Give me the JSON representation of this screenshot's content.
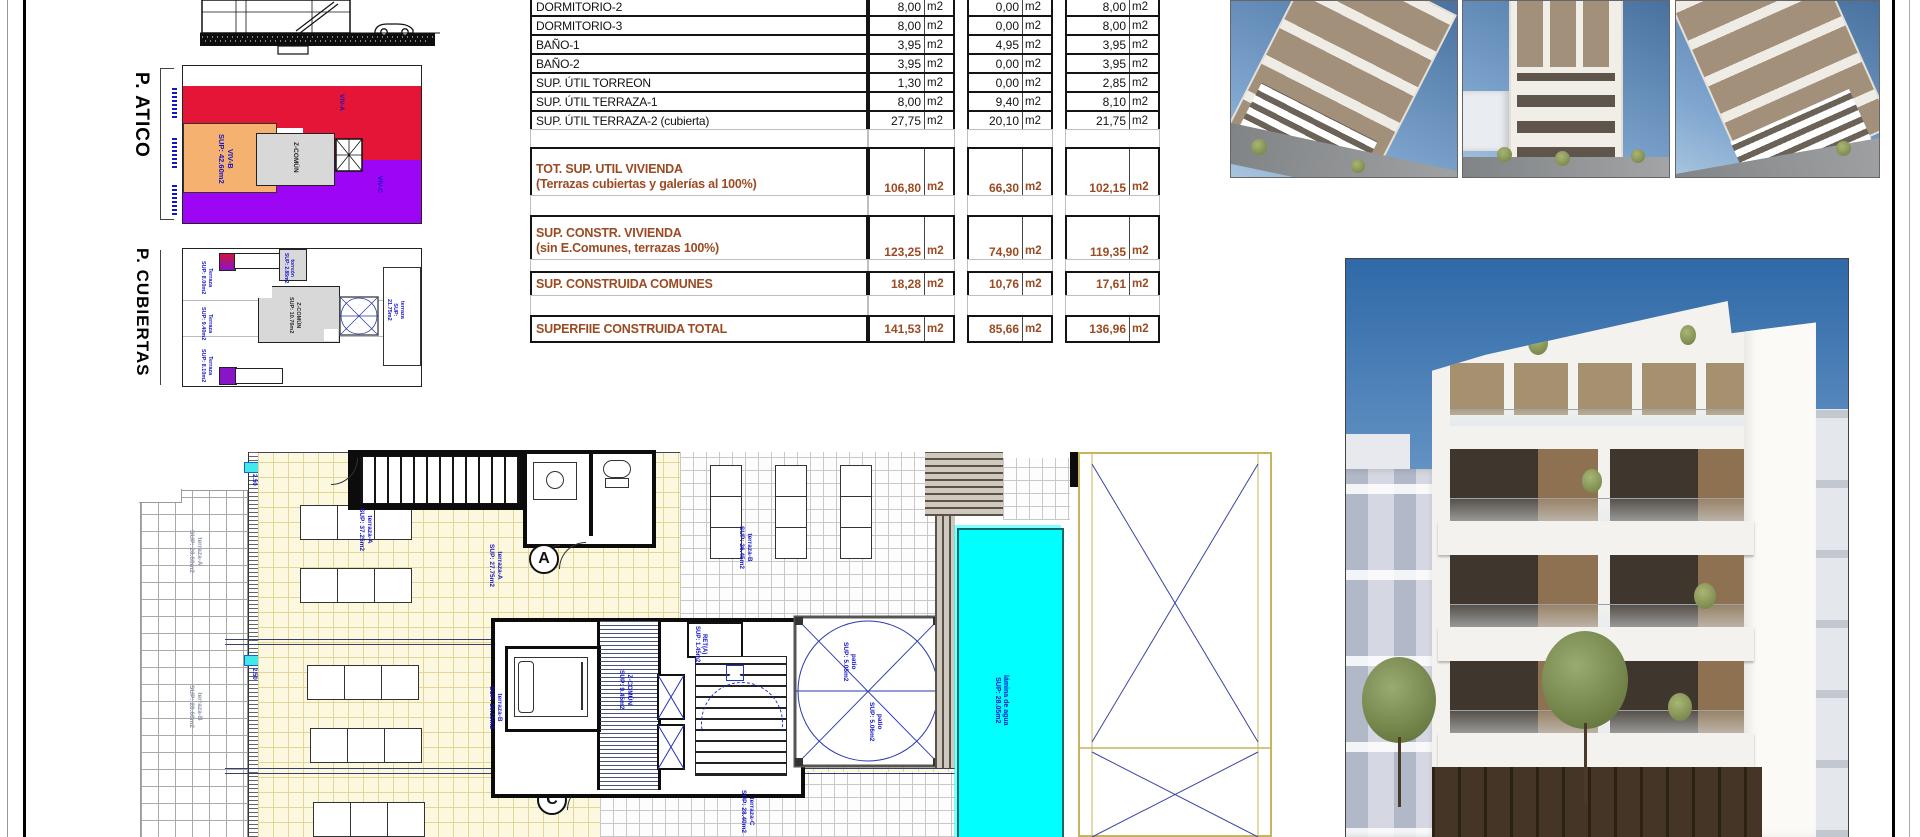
{
  "panels": {
    "atico": {
      "title": "P. ATICO",
      "viv_a": "VIV-A",
      "viv_b": "VIV-B\nSUP: 42.60m2",
      "common": "Z-COMÚN",
      "viv_c": "VIV-C"
    },
    "cubiertas": {
      "title": "P. CUBIERTAS",
      "terraza_1": "Terraza\nSUP: 8.00m2",
      "terraza_2": "Terraza\nSUP: 9.40m2",
      "terraza_3": "Terraza\nSUP: 8.10m2",
      "core": "Z-COMÚN\nSUP: 10.76m2",
      "torreon": "torreón\nSUP: 2.85m2",
      "terraza_r": "terraza\nSUP: 21.75m2"
    }
  },
  "area_table": {
    "unit": "m2",
    "rows": [
      {
        "label": "DORMITORIO-2",
        "v": [
          "8,00",
          "0,00",
          "8,00"
        ]
      },
      {
        "label": "DORMITORIO-3",
        "v": [
          "8,00",
          "0,00",
          "8,00"
        ]
      },
      {
        "label": "BAÑO-1",
        "v": [
          "3,95",
          "4,95",
          "3,95"
        ]
      },
      {
        "label": "BAÑO-2",
        "v": [
          "3,95",
          "0,00",
          "3,95"
        ]
      },
      {
        "label": "SUP. ÚTIL TORREON",
        "v": [
          "1,30",
          "0,00",
          "2,85"
        ]
      },
      {
        "label": "SUP. ÚTIL TERRAZA-1",
        "v": [
          "8,00",
          "9,40",
          "8,10"
        ]
      },
      {
        "label": "SUP. ÚTIL TERRAZA-2 (cubierta)",
        "v": [
          "27,75",
          "20,10",
          "21,75"
        ]
      }
    ],
    "totals": [
      {
        "label": "TOT. SUP. UTIL VIVIENDA",
        "sub": "(Terrazas cubiertas y galerías al 100%)",
        "v": [
          "106,80",
          "66,30",
          "102,15"
        ]
      },
      {
        "label": "SUP. CONSTR. VIVIENDA",
        "sub": "(sin E.Comunes, terrazas 100%)",
        "v": [
          "123,25",
          "74,90",
          "119,35"
        ]
      },
      {
        "label": "SUP. CONSTRUIDA COMUNES",
        "sub": "",
        "v": [
          "18,28",
          "10,76",
          "17,61"
        ]
      },
      {
        "label": "SUPERFIIE CONSTRUIDA TOTAL",
        "sub": "",
        "v": [
          "141,53",
          "85,66",
          "136,96"
        ]
      }
    ]
  },
  "floor_plan": {
    "markers": {
      "a": "A",
      "b": "B",
      "c": "C"
    },
    "labels": {
      "terraza_a1": "terraza-A\nSUP: 37.25m2",
      "terraza_a2": "terraza-A\nSUP: 27.75m2",
      "terraza_b1": "terraza-B\nSUP: 26.45m2",
      "terraza_b2": "terraza-B\nSUP: 20.15m2",
      "terraza_c": "terraza-C\nSUP: 28.40m2",
      "patio_a": "patio\nSUP: 5.05m2",
      "patio_b": "patio\nSUP: 5.06m2",
      "pool": "lámina de agua\nSUP: 28.05m2",
      "common": "Z-COMÚN\nSUP: 9.45m2",
      "ret": "RET(A)\nSUP: 1.45m2",
      "stair": "SUP: 1.60m2",
      "gray_a": "terraza-A\nSUP: 28.60m2",
      "gray_b": "terraza-B\nSUP: 28.60m2",
      "dim_a": "2.50",
      "dim_b": "2.50"
    }
  },
  "colors": {
    "viv_a": "#e51537",
    "viv_b": "#f5b170",
    "viv_c": "#9d05f5",
    "common_zone": "#d8d8d8",
    "pool": "#00ffff",
    "cad_blue": "#1414c8",
    "table_brown": "#9c4a22"
  }
}
